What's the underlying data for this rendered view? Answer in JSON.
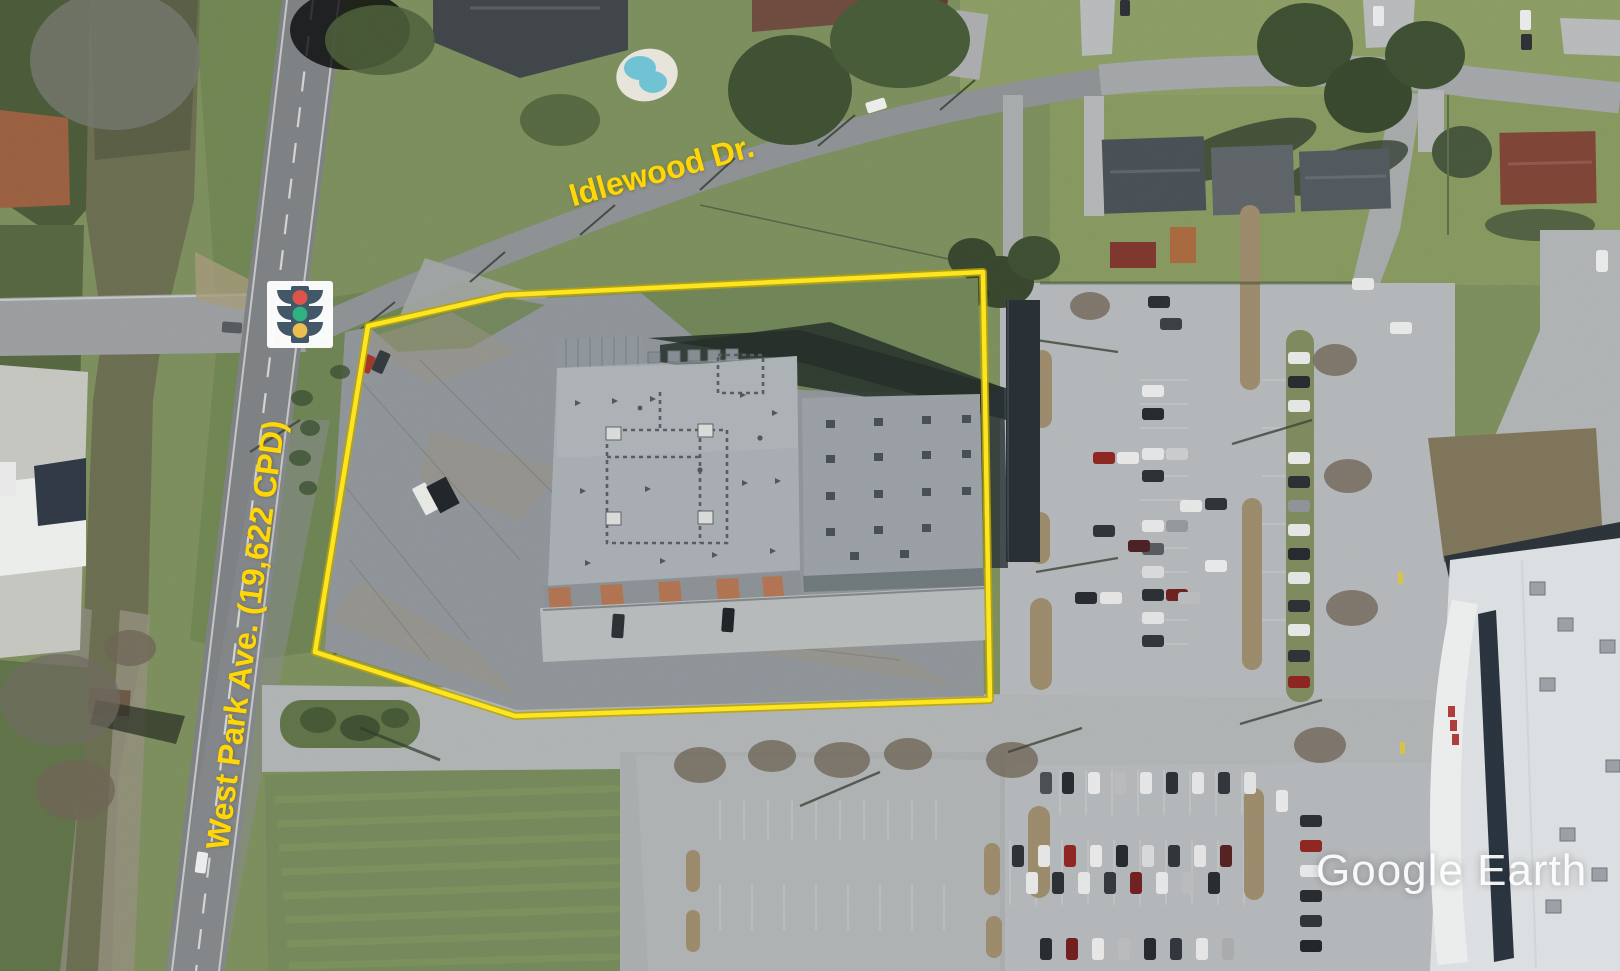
{
  "map": {
    "view_type": "satellite-aerial",
    "watermark": "Google Earth",
    "streets": {
      "idlewood": "Idlewood Dr.",
      "west_park": "West Park Ave. (19,622 CPD)"
    },
    "traffic_count_cpd": "19,622",
    "parcel_outline_points": "368,326 505,295 983,272 990,700 515,716 315,652",
    "annotation_colors": {
      "parcel_outline": "#ffe61f",
      "parcel_outline_halo": "#b8a500",
      "street_label": "#ffd608",
      "watermark_text": "#ffffff"
    },
    "traffic_signal_icon": {
      "name": "traffic-light-icon",
      "body": "#3f5666",
      "background": "#ffffff",
      "red": "#df5147",
      "green": "#2eb180",
      "yellow": "#ecbf4d"
    }
  }
}
